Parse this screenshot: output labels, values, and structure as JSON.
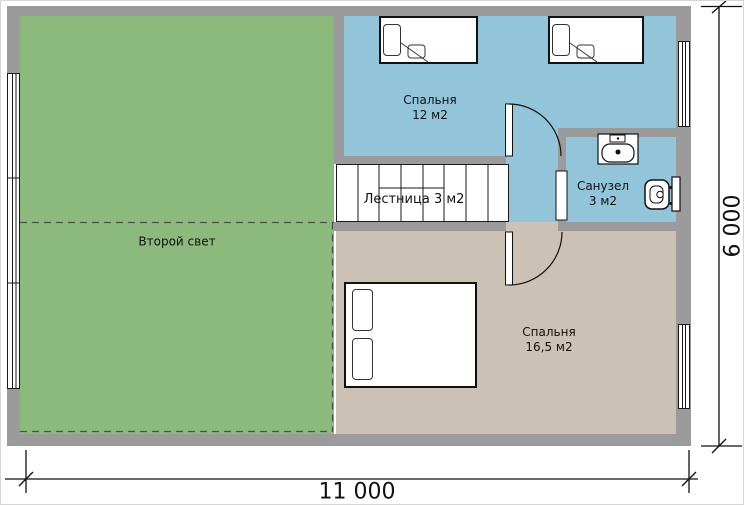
{
  "rooms": {
    "second_light": {
      "label": "Второй свет"
    },
    "bedroom_small": {
      "label": "Спальня",
      "area": "12 м2"
    },
    "bathroom": {
      "label": "Санузел",
      "area": "3 м2"
    },
    "stairs": {
      "label": "Лестница 3 м2"
    },
    "bedroom_large": {
      "label": "Спальня",
      "area": "16,5 м2"
    }
  },
  "dimensions": {
    "bottom_width": "11 000",
    "right_height": "6 000"
  },
  "colors": {
    "wall_gray": "#9b9b9b",
    "second_light_green": "#8cba7c",
    "bedroom_bath_blue": "#92c5d9",
    "bedroom_beige": "#cbc2b5",
    "furniture_white": "#ffffff",
    "line_black": "#1a1a1a"
  },
  "icons": {
    "beds": [
      "single-bed-icon",
      "single-bed-icon",
      "double-bed-icon"
    ],
    "bathroom_fixtures": [
      "sink-icon",
      "toilet-icon"
    ],
    "openings": [
      "door-arc-icon",
      "door-arc-icon",
      "bathroom-door-icon",
      "window-icon",
      "window-icon",
      "window-icon"
    ],
    "stairs": "stairs-steps-icon"
  }
}
